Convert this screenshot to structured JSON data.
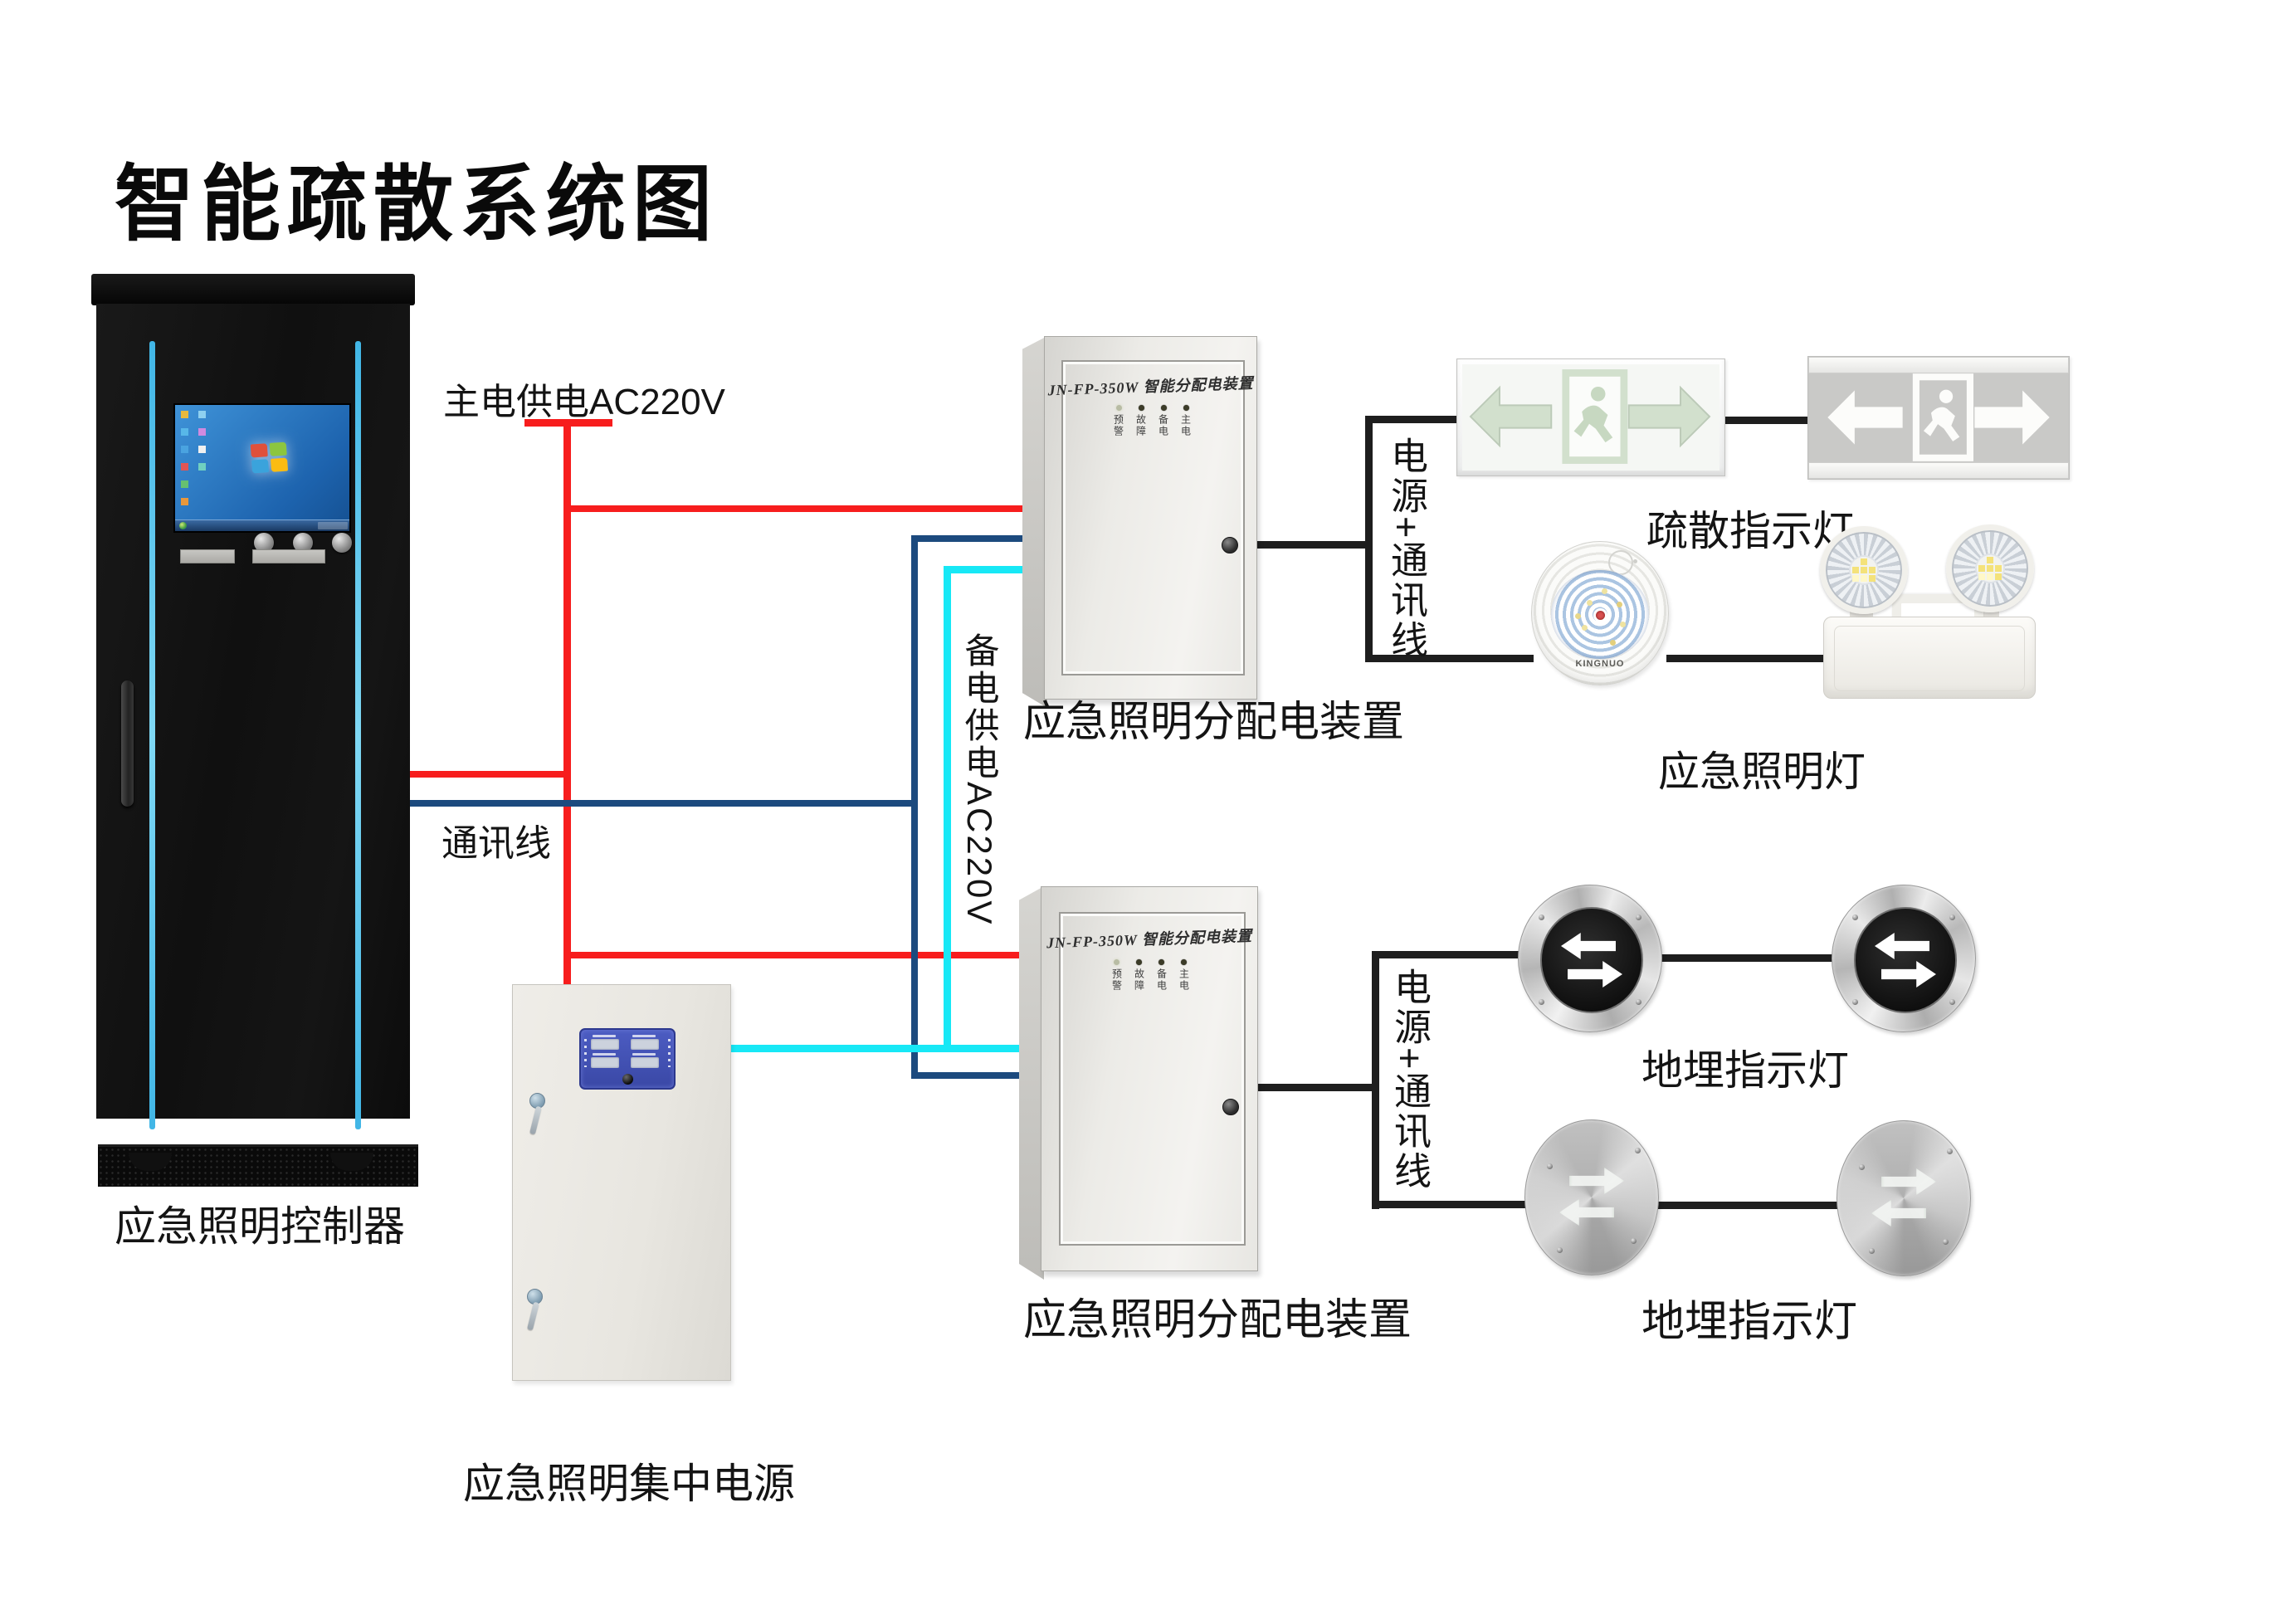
{
  "title": "智能疏散系统图",
  "colors": {
    "main_power_red": "#f71d1d",
    "comm_navy": "#1c4a7e",
    "backup_cyan": "#17e8f6",
    "device_line_black": "#1e1e1e",
    "accent_strip": "#41b6e6"
  },
  "annotations": {
    "main_power": "主电供电AC220V",
    "comm_line": "通讯线",
    "backup_power": "备电供电AC220V",
    "power_comm_top": "电源+通讯线",
    "power_comm_bottom": "电源+通讯线"
  },
  "controller": {
    "label": "应急照明控制器"
  },
  "power_supply": {
    "label": "应急照明集中电源"
  },
  "distribution_box_1": {
    "label": "应急照明分配电装置",
    "panel_title": "JN-FP-350W 智能分配电装置",
    "led_labels": [
      "预警",
      "故障",
      "备电",
      "主电"
    ]
  },
  "distribution_box_2": {
    "label": "应急照明分配电装置",
    "panel_title": "JN-FP-350W 智能分配电装置",
    "led_labels": [
      "预警",
      "故障",
      "备电",
      "主电"
    ]
  },
  "exit_signs": {
    "label": "疏散指示灯"
  },
  "emergency_lights": {
    "label": "应急照明灯",
    "brand": "KINGNUO"
  },
  "ground_lights_1": {
    "label": "地埋指示灯"
  },
  "ground_lights_2": {
    "label": "地埋指示灯"
  }
}
